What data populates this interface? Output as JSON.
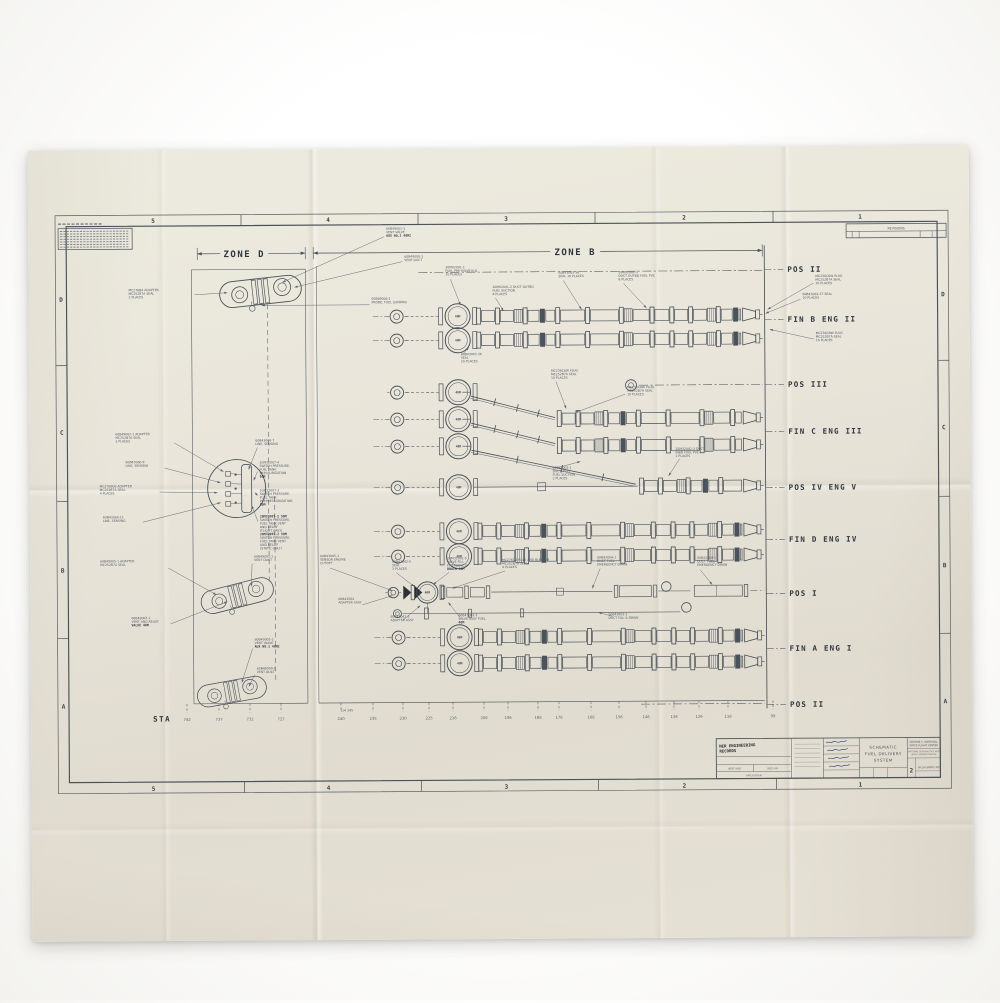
{
  "colors": {
    "paper": "#e9e5da",
    "ink": "#4a5158",
    "stencil": "#30373f",
    "faded_text": "#565d66"
  },
  "diagram": {
    "zone_d_label": "ZONE D",
    "zone_b_label": "ZONE B",
    "sta_label": "STA",
    "quarter_label": "1/4 345",
    "revisions_label": "REVISIONS",
    "valve_label": "40M",
    "grid": {
      "cols": [
        "5",
        "4",
        "3",
        "2",
        "1"
      ],
      "rows": [
        "D",
        "C",
        "B",
        "A"
      ]
    },
    "position_labels": [
      {
        "text": "POS II",
        "y": 271
      },
      {
        "text": "FIN B  ENG II",
        "y": 321
      },
      {
        "text": "POS III",
        "y": 386
      },
      {
        "text": "FIN C  ENG III",
        "y": 433
      },
      {
        "text": "POS IV ENG V",
        "y": 489
      },
      {
        "text": "FIN D  ENG IV",
        "y": 541
      },
      {
        "text": "POS I",
        "y": 595
      },
      {
        "text": "FIN A  ENG I",
        "y": 650
      },
      {
        "text": "POS II",
        "y": 706
      }
    ],
    "stations": [
      {
        "t": "742",
        "x": 186
      },
      {
        "t": "737",
        "x": 218
      },
      {
        "t": "732",
        "x": 249
      },
      {
        "t": "727",
        "x": 280
      },
      {
        "t": "240",
        "x": 340
      },
      {
        "t": "235",
        "x": 372
      },
      {
        "t": "230",
        "x": 402
      },
      {
        "t": "225",
        "x": 428
      },
      {
        "t": "216",
        "x": 452
      },
      {
        "t": "206",
        "x": 483
      },
      {
        "t": "196",
        "x": 507
      },
      {
        "t": "186",
        "x": 537
      },
      {
        "t": "176",
        "x": 558
      },
      {
        "t": "166",
        "x": 590
      },
      {
        "t": "156",
        "x": 618
      },
      {
        "t": "146",
        "x": 645
      },
      {
        "t": "136",
        "x": 673
      },
      {
        "t": "126",
        "x": 698
      },
      {
        "t": "116",
        "x": 727
      },
      {
        "t": "99",
        "x": 772
      }
    ],
    "duct_rows": [
      {
        "y": 316,
        "ring": 398,
        "valve": 459,
        "start": 478
      },
      {
        "y": 340,
        "ring": 398,
        "valve": 459,
        "start": 478
      },
      {
        "y": 419,
        "start": 558
      },
      {
        "y": 446,
        "start": 558
      },
      {
        "y": 487,
        "ring": 398,
        "valve": 459,
        "thin": [
          474,
          638
        ],
        "start": 640
      },
      {
        "y": 531,
        "ring": 398,
        "valve": 459,
        "start": 478
      },
      {
        "y": 556,
        "ring": 398,
        "valve": 459,
        "start": 478
      },
      {
        "y": 637,
        "ring": 398,
        "valve": 459,
        "start": 478
      },
      {
        "y": 663,
        "ring": 398,
        "valve": 459,
        "start": 478
      }
    ],
    "stub_rows": [
      {
        "y": 392
      },
      {
        "y": 419
      },
      {
        "y": 446
      }
    ],
    "diagonals": [
      [
        472,
        396,
        556,
        418
      ],
      [
        472,
        423,
        556,
        444
      ],
      [
        472,
        450,
        636,
        485
      ]
    ],
    "centerlines": [
      [
        420,
        272,
        764,
        272
      ],
      [
        640,
        386,
        764,
        386
      ],
      [
        640,
        705,
        764,
        705
      ]
    ],
    "pos3_ring": [
      632,
      386
    ],
    "vent_assemblies": [
      {
        "cx": 262,
        "cy": 290,
        "rot": -6,
        "s": 1
      },
      {
        "cx": 237,
        "cy": 594,
        "rot": -14,
        "s": 0.9
      },
      {
        "cx": 231,
        "cy": 690,
        "rot": -10,
        "s": 0.85
      }
    ],
    "callouts": [
      {
        "x": 388,
        "y": 229,
        "lines": [
          "60B49001-1",
          "VENT VALVE",
          "AUX NO.2 40M2"
        ],
        "leader": [
          386,
          236,
          284,
          281
        ]
      },
      {
        "x": 406,
        "y": 257,
        "lines": [
          "60B49000-1",
          "VENT DUCT"
        ],
        "leader": [
          404,
          261,
          296,
          286
        ]
      },
      {
        "x": 130,
        "y": 289,
        "lines": [
          "MC276B4 ADAPTER",
          "MC252B7A SEAL",
          "2 PLACES"
        ],
        "leader": [
          196,
          293,
          229,
          291
        ]
      },
      {
        "x": 373,
        "y": 299,
        "lines": [
          "60B49006-1",
          "PROBE, FUEL LOADING"
        ],
        "leader": [
          371,
          304,
          263,
          304
        ]
      },
      {
        "x": 447,
        "y": 268,
        "lines": [
          "20M02001-1",
          "FUEL PRE-VALVE N.O.",
          "10 PLACES"
        ],
        "leader": [
          452,
          279,
          462,
          305
        ]
      },
      {
        "x": 494,
        "y": 288,
        "lines": [
          "20M02001-2 DUCT OUTBD",
          "FUEL SUCTION",
          "8 PLACES"
        ],
        "leader": [
          497,
          298,
          505,
          311
        ]
      },
      {
        "x": 560,
        "y": 274,
        "lines": [
          "60B43063-36",
          "SEAL 10 PLACES"
        ],
        "leader": [
          565,
          281,
          583,
          310
        ]
      },
      {
        "x": 620,
        "y": 274,
        "lines": [
          "20M02001-3",
          "DUCT OUTBD FUEL PVC",
          "8 PLACES"
        ],
        "leader": [
          625,
          284,
          648,
          309
        ]
      },
      {
        "x": 462,
        "y": 355,
        "lines": [
          "60B43063-36",
          "SEAL",
          "20 PLACES"
        ],
        "leader": [
          464,
          354,
          470,
          347
        ]
      },
      {
        "x": 817,
        "y": 279,
        "lines": [
          "MC236C6W PLUG",
          "MC252B7A SEAL",
          "10 PLACES"
        ],
        "leader": [
          815,
          285,
          769,
          311
        ]
      },
      {
        "x": 804,
        "y": 297,
        "lines": [
          "60B43063-37 SEAL",
          "10 PLACES"
        ],
        "leader": [
          802,
          301,
          767,
          315
        ]
      },
      {
        "x": 817,
        "y": 336,
        "lines": [
          "MC236C8W PLUG",
          "MC252B7A SEAL",
          "10 PLACES"
        ],
        "leader": [
          815,
          341,
          771,
          331
        ]
      },
      {
        "x": 552,
        "y": 372,
        "lines": [
          "MC236C6W PLUG",
          "MC252B7A SEAL",
          "10 PLACES"
        ],
        "leader": [
          557,
          382,
          567,
          409
        ]
      },
      {
        "x": 628,
        "y": 389,
        "lines": [
          "MC236C8W PLUG",
          "MC252B7A SEAL",
          "10 PLACES"
        ],
        "leader": [
          626,
          395,
          576,
          413
        ]
      },
      {
        "x": 676,
        "y": 451,
        "lines": [
          "20M32002-3 DUCT",
          "INBD FUEL PVC",
          "2 PLACES"
        ],
        "leader": [
          680,
          460,
          669,
          477
        ]
      },
      {
        "x": 553,
        "y": 469,
        "lines": [
          "60B43002-1",
          "DUCT ASSY",
          "FUEL SUCTION",
          "2 PLACES"
        ],
        "leader": [
          558,
          468,
          581,
          462
        ]
      },
      {
        "x": 116,
        "y": 433,
        "lines": [
          "60B49002-1 ADAPTER",
          "MC252B7A SEAL",
          "3 PLACES"
        ],
        "leader": [
          175,
          441,
          224,
          470
        ]
      },
      {
        "x": 126,
        "y": 461,
        "lines": [
          "60B43060-9",
          "LINE, SENSING"
        ],
        "leader": [
          165,
          466,
          221,
          481
        ]
      },
      {
        "x": 100,
        "y": 485,
        "lines": [
          "MC276B06 ADAPTER",
          "MC252B7A SEAL",
          "4 PLACES"
        ],
        "leader": [
          160,
          490,
          218,
          491
        ]
      },
      {
        "x": 103,
        "y": 516,
        "lines": [
          "60B43060-11",
          "LINE, SENSING"
        ],
        "leader": [
          143,
          520,
          221,
          501
        ]
      },
      {
        "x": 256,
        "y": 440,
        "lines": [
          "60B43060-7",
          "LINE, SENSING"
        ],
        "leader": [
          258,
          446,
          249,
          468
        ]
      },
      {
        "x": 260,
        "y": 462,
        "lines": [
          "20M32007-4",
          "SWITCH PRESSURE,",
          "FUEL TANK",
          "PRESSURIZATION",
          "50M"
        ],
        "leader": [
          258,
          470,
          254,
          479
        ]
      },
      {
        "x": 260,
        "y": 490,
        "lines": [
          "20M32007-3",
          "SWITCH PRESSURE,",
          "FUEL TANK",
          "PREPRESSURIZATION",
          "50M"
        ],
        "leader": [
          258,
          494,
          255,
          491
        ]
      },
      {
        "x": 260,
        "y": 516,
        "lines": [
          "20M32007-1 50M",
          "SWITCH PRESSURE,",
          "FUEL TANK VENT",
          "AND RELIEF",
          "(FLIGHT ONLY)",
          "20M32007-2 50M",
          "SWITCH PRESSURE,",
          "FUEL TANK VENT",
          "AND RELIEF",
          "(STATIC ONLY)"
        ],
        "leader": [
          258,
          520,
          252,
          504
        ]
      },
      {
        "x": 100,
        "y": 560,
        "lines": [
          "60B49005-1 ADAPTER",
          "MC252B7A SEAL"
        ],
        "leader": [
          168,
          566,
          216,
          593
        ]
      },
      {
        "x": 254,
        "y": 556,
        "lines": [
          "60B49001-1",
          "VENT DUCT"
        ],
        "leader": [
          252,
          562,
          251,
          585
        ]
      },
      {
        "x": 131,
        "y": 617,
        "lines": [
          "60B49003-1",
          "VENT AND RELIEF",
          "VALVE 40M"
        ],
        "leader": [
          170,
          622,
          227,
          600
        ]
      },
      {
        "x": 254,
        "y": 639,
        "lines": [
          "60B49005-2",
          "VENT VALVE",
          "AUX NO.1 40M2"
        ],
        "leader": [
          252,
          647,
          241,
          681
        ]
      },
      {
        "x": 256,
        "y": 668,
        "lines": [
          "60B49000-1",
          "VENT DUCT"
        ],
        "leader": [
          254,
          673,
          248,
          685
        ]
      },
      {
        "x": 320,
        "y": 556,
        "lines": [
          "60B43005-1",
          "SENSOR ENGINE",
          "CUTOFF"
        ],
        "leader": [
          330,
          567,
          392,
          590
        ]
      },
      {
        "x": 392,
        "y": 562,
        "lines": [
          "60B43042-5",
          "SEAL",
          "3 PLACES"
        ],
        "leader": [
          396,
          572,
          414,
          586
        ]
      },
      {
        "x": 447,
        "y": 559,
        "lines": [
          "20M32001-5",
          "VALVE FILL",
          "EMERGENCY",
          "DRAIN 40M"
        ],
        "leader": [
          449,
          572,
          433,
          584
        ]
      },
      {
        "x": 502,
        "y": 561,
        "lines": [
          "MC276D4 PLUG AND BLEEDER",
          "MC252B7A SEAL",
          "4 PLACES"
        ],
        "leader": [
          505,
          571,
          452,
          588
        ]
      },
      {
        "x": 597,
        "y": 559,
        "lines": [
          "60B43004-1",
          "DUCT FUEL",
          "EMERGENCY DRAIN"
        ],
        "leader": [
          600,
          569,
          592,
          589
        ]
      },
      {
        "x": 697,
        "y": 560,
        "lines": [
          "60B43004-1",
          "DUCT FUEL",
          "EMERGENCY DRAIN"
        ],
        "leader": [
          700,
          571,
          712,
          586
        ]
      },
      {
        "x": 338,
        "y": 599,
        "lines": [
          "60B43004",
          "ADAPTER ASSY"
        ],
        "leader": [
          362,
          604,
          392,
          595
        ]
      },
      {
        "x": 390,
        "y": 617,
        "lines": [
          "60B43042-3",
          "ADAPTER ASSY"
        ],
        "leader": [
          402,
          620,
          420,
          605
        ]
      },
      {
        "x": 458,
        "y": 616,
        "lines": [
          "60B43002-1",
          "VALVE ASSY FUEL",
          "40M"
        ],
        "leader": [
          460,
          618,
          448,
          602
        ]
      },
      {
        "x": 608,
        "y": 616,
        "lines": [
          "60B43003-1",
          "DUCT FILL & DRAIN"
        ],
        "leader": [
          612,
          617,
          598,
          613
        ]
      }
    ],
    "title_block": {
      "stamp_lines": [
        "NER ENGINEERING",
        "RECORDS"
      ],
      "next_assy": "NEXT ASSY",
      "used_on": "USED ON",
      "application": "APPLICATION",
      "title_lines": [
        "SCHEMATIC",
        "FUEL DELIVERY",
        "SYSTEM"
      ],
      "org_lines": [
        "GEORGE C. MARSHALL",
        "SPACE FLIGHT CENTER",
        "NATIONAL AERONAUTICS AND",
        "SPACE ADMINISTRATION"
      ],
      "size": "2",
      "number": "SK10-GM50C-455"
    }
  }
}
